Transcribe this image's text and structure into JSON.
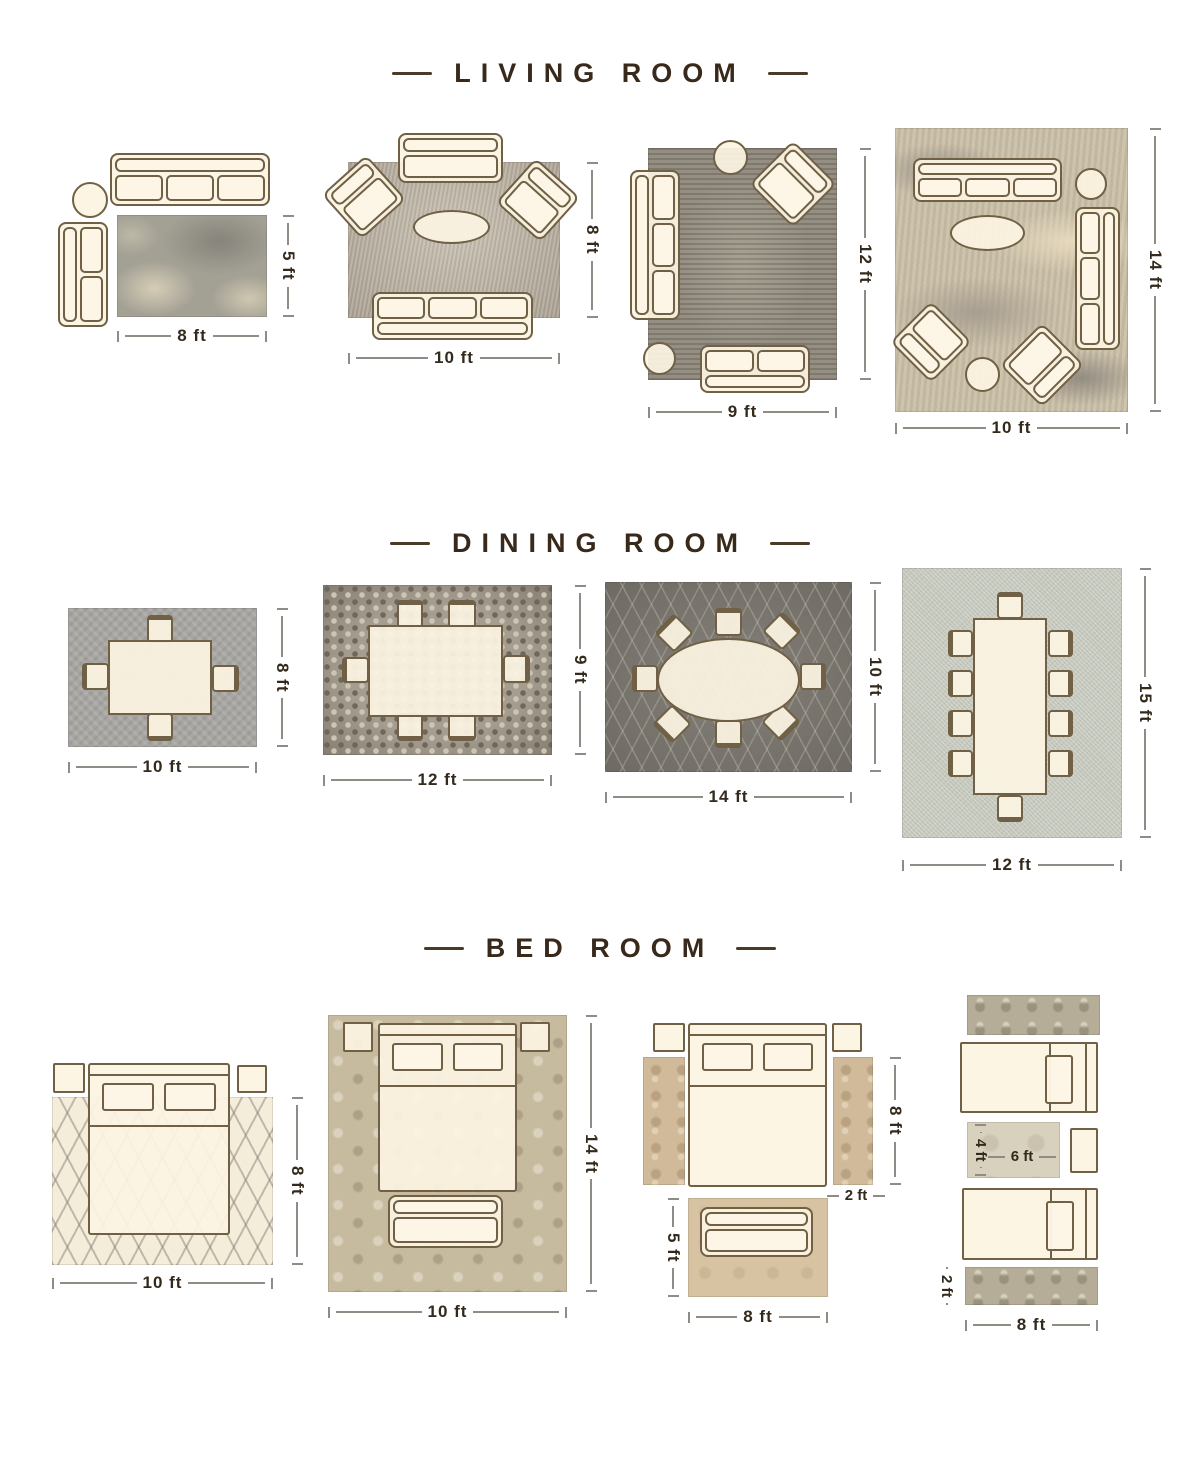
{
  "page_title": "Rug size guide",
  "accent_color": "#38291b",
  "line_color": "#8e8c84",
  "furniture_fill": "#fcf4e2",
  "furniture_outline": "#6f6046",
  "sections": {
    "living_room": {
      "title": "LIVING ROOM",
      "layouts": [
        {
          "width_label": "8 ft",
          "height_label": "5 ft",
          "furniture": [
            "3-seat sofa",
            "round side table",
            "2-seat sofa"
          ]
        },
        {
          "width_label": "10 ft",
          "height_label": "8 ft",
          "furniture": [
            "loveseat",
            "armchair",
            "armchair",
            "oval coffee table",
            "3-seat sofa"
          ]
        },
        {
          "width_label": "9 ft",
          "height_label": "12 ft",
          "furniture": [
            "3-seat sofa",
            "round table",
            "armchair",
            "round table",
            "loveseat"
          ]
        },
        {
          "width_label": "10 ft",
          "height_label": "14 ft",
          "furniture": [
            "3-seat sofa",
            "round table",
            "3-seat sofa",
            "oval coffee table",
            "armchair",
            "round table",
            "armchair"
          ]
        }
      ]
    },
    "dining_room": {
      "title": "DINING ROOM",
      "layouts": [
        {
          "width_label": "10 ft",
          "height_label": "8 ft",
          "furniture": [
            "dining table",
            "4 chairs"
          ]
        },
        {
          "width_label": "12 ft",
          "height_label": "9 ft",
          "furniture": [
            "dining table",
            "6 chairs"
          ]
        },
        {
          "width_label": "14 ft",
          "height_label": "10 ft",
          "furniture": [
            "oval dining table",
            "8 chairs"
          ]
        },
        {
          "width_label": "12 ft",
          "height_label": "15 ft",
          "furniture": [
            "long dining table",
            "10 chairs"
          ]
        }
      ]
    },
    "bed_room": {
      "title": "BED ROOM",
      "layouts": [
        {
          "width_label": "10 ft",
          "height_label": "8 ft",
          "furniture": [
            "queen bed",
            "nightstand",
            "nightstand"
          ]
        },
        {
          "width_label": "10 ft",
          "height_label": "14 ft",
          "furniture": [
            "queen bed",
            "nightstand",
            "nightstand",
            "bench sofa"
          ]
        },
        {
          "runner_height_label": "8 ft",
          "runner_width_label": "2 ft",
          "rug_height_label": "5 ft",
          "rug_width_label": "8 ft",
          "furniture": [
            "queen bed",
            "nightstand",
            "nightstand",
            "runner rug",
            "runner rug",
            "bench sofa"
          ]
        },
        {
          "mid_rug_height_label": "4 ft",
          "mid_rug_width_label": "6 ft",
          "runner_height_label": "2 ft",
          "runner_width_label": "8 ft",
          "furniture": [
            "runner rug",
            "twin bed",
            "accent rug",
            "nightstand",
            "twin bed",
            "runner rug"
          ]
        }
      ]
    }
  }
}
